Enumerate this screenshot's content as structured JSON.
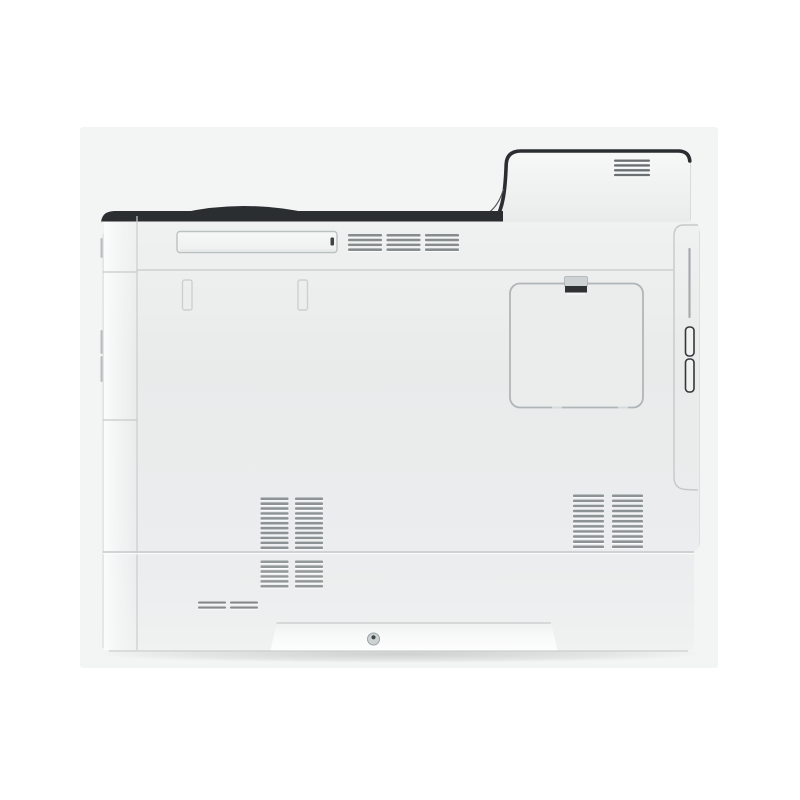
{
  "photo": {
    "subject": "Color laser printer, right side view product photo",
    "background_color": "#ffffff",
    "backdrop_color": "#f3f4f4",
    "colors": {
      "outline": "#2b2e30",
      "body_fill": "#eaecec",
      "body_light": "#f1f2f2",
      "seam": "#c5c9ca",
      "panel_border": "#b0b6b8",
      "latch_dark": "#2f3334",
      "vent_bar": "#8d9395",
      "strip_highlight": "#fafbfb"
    },
    "parts": {
      "top_cover": "raised-top-cover",
      "top_cover_vent": "exhaust-vent-top-cover",
      "output_tray_trim": "dark-output-tray-trim",
      "grip_slot": "recessed-grip-slot",
      "upper_vents": "upper-intake-vents",
      "access_panel": "toner-access-panel",
      "access_panel_latch": "access-panel-latch",
      "side_vents_left": "side-vents-lower-left",
      "side_vents_right": "side-vents-lower-right",
      "tray_vents": "paper-tray-vents",
      "tray_dash_vents": "paper-tray-dash-vents",
      "handle_recess": "recessed-carry-handle",
      "screw": "handle-screw",
      "rear_seam": "rear-cover-seam",
      "rear_latch_buttons": "rear-cover-release-latch"
    },
    "vents": [
      {
        "x": 614,
        "y": 159.5,
        "cols": 1,
        "colW": 36,
        "gap": 0,
        "rows": 4,
        "rowStep": 4.8,
        "barH": 2.4,
        "color": "#6b7173"
      },
      {
        "x": 348,
        "y": 234,
        "cols": 3,
        "colW": 34,
        "gap": 4.5,
        "rows": 4,
        "rowStep": 4.8,
        "barH": 2.6,
        "color": "#878d8f"
      },
      {
        "x": 260.5,
        "y": 497.5,
        "cols": 2,
        "colW": 28,
        "gap": 6.5,
        "rows": 11,
        "rowStep": 4.9,
        "barH": 2.6,
        "color": "#8d9395"
      },
      {
        "x": 573,
        "y": 494.5,
        "cols": 2,
        "colW": 31,
        "gap": 8,
        "rows": 11,
        "rowStep": 5.1,
        "barH": 2.6,
        "color": "#8d9395"
      },
      {
        "x": 260.5,
        "y": 560.5,
        "cols": 2,
        "colW": 28,
        "gap": 6.5,
        "rows": 6,
        "rowStep": 4.9,
        "barH": 2.6,
        "color": "#939899"
      },
      {
        "x": 198,
        "y": 601.5,
        "cols": 2,
        "colW": 28,
        "gap": 4,
        "rows": 2,
        "rowStep": 5,
        "barH": 2.2,
        "color": "#85898b"
      }
    ]
  }
}
